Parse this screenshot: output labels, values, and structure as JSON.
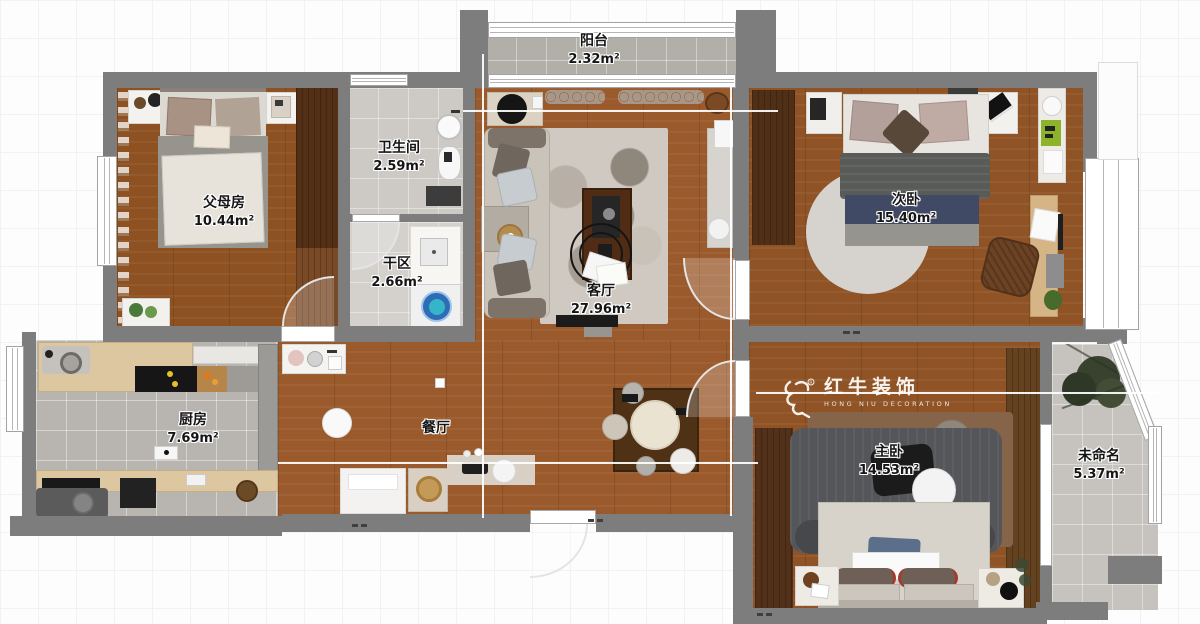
{
  "watermark": {
    "registered": "®",
    "brand": "红牛装饰",
    "subtitle": "HONG NIU DECORATION"
  },
  "rooms": [
    {
      "name": "阳台",
      "area": "2.32m²"
    },
    {
      "name": "父母房",
      "area": "10.44m²"
    },
    {
      "name": "卫生间",
      "area": "2.59m²"
    },
    {
      "name": "干区",
      "area": "2.66m²"
    },
    {
      "name": "客厅",
      "area": "27.96m²"
    },
    {
      "name": "次卧",
      "area": "15.40m²"
    },
    {
      "name": "厨房",
      "area": "7.69m²"
    },
    {
      "name": "餐厅",
      "area": ""
    },
    {
      "name": "主卧",
      "area": "14.53m²"
    },
    {
      "name": "未命名",
      "area": "5.37m²"
    }
  ]
}
